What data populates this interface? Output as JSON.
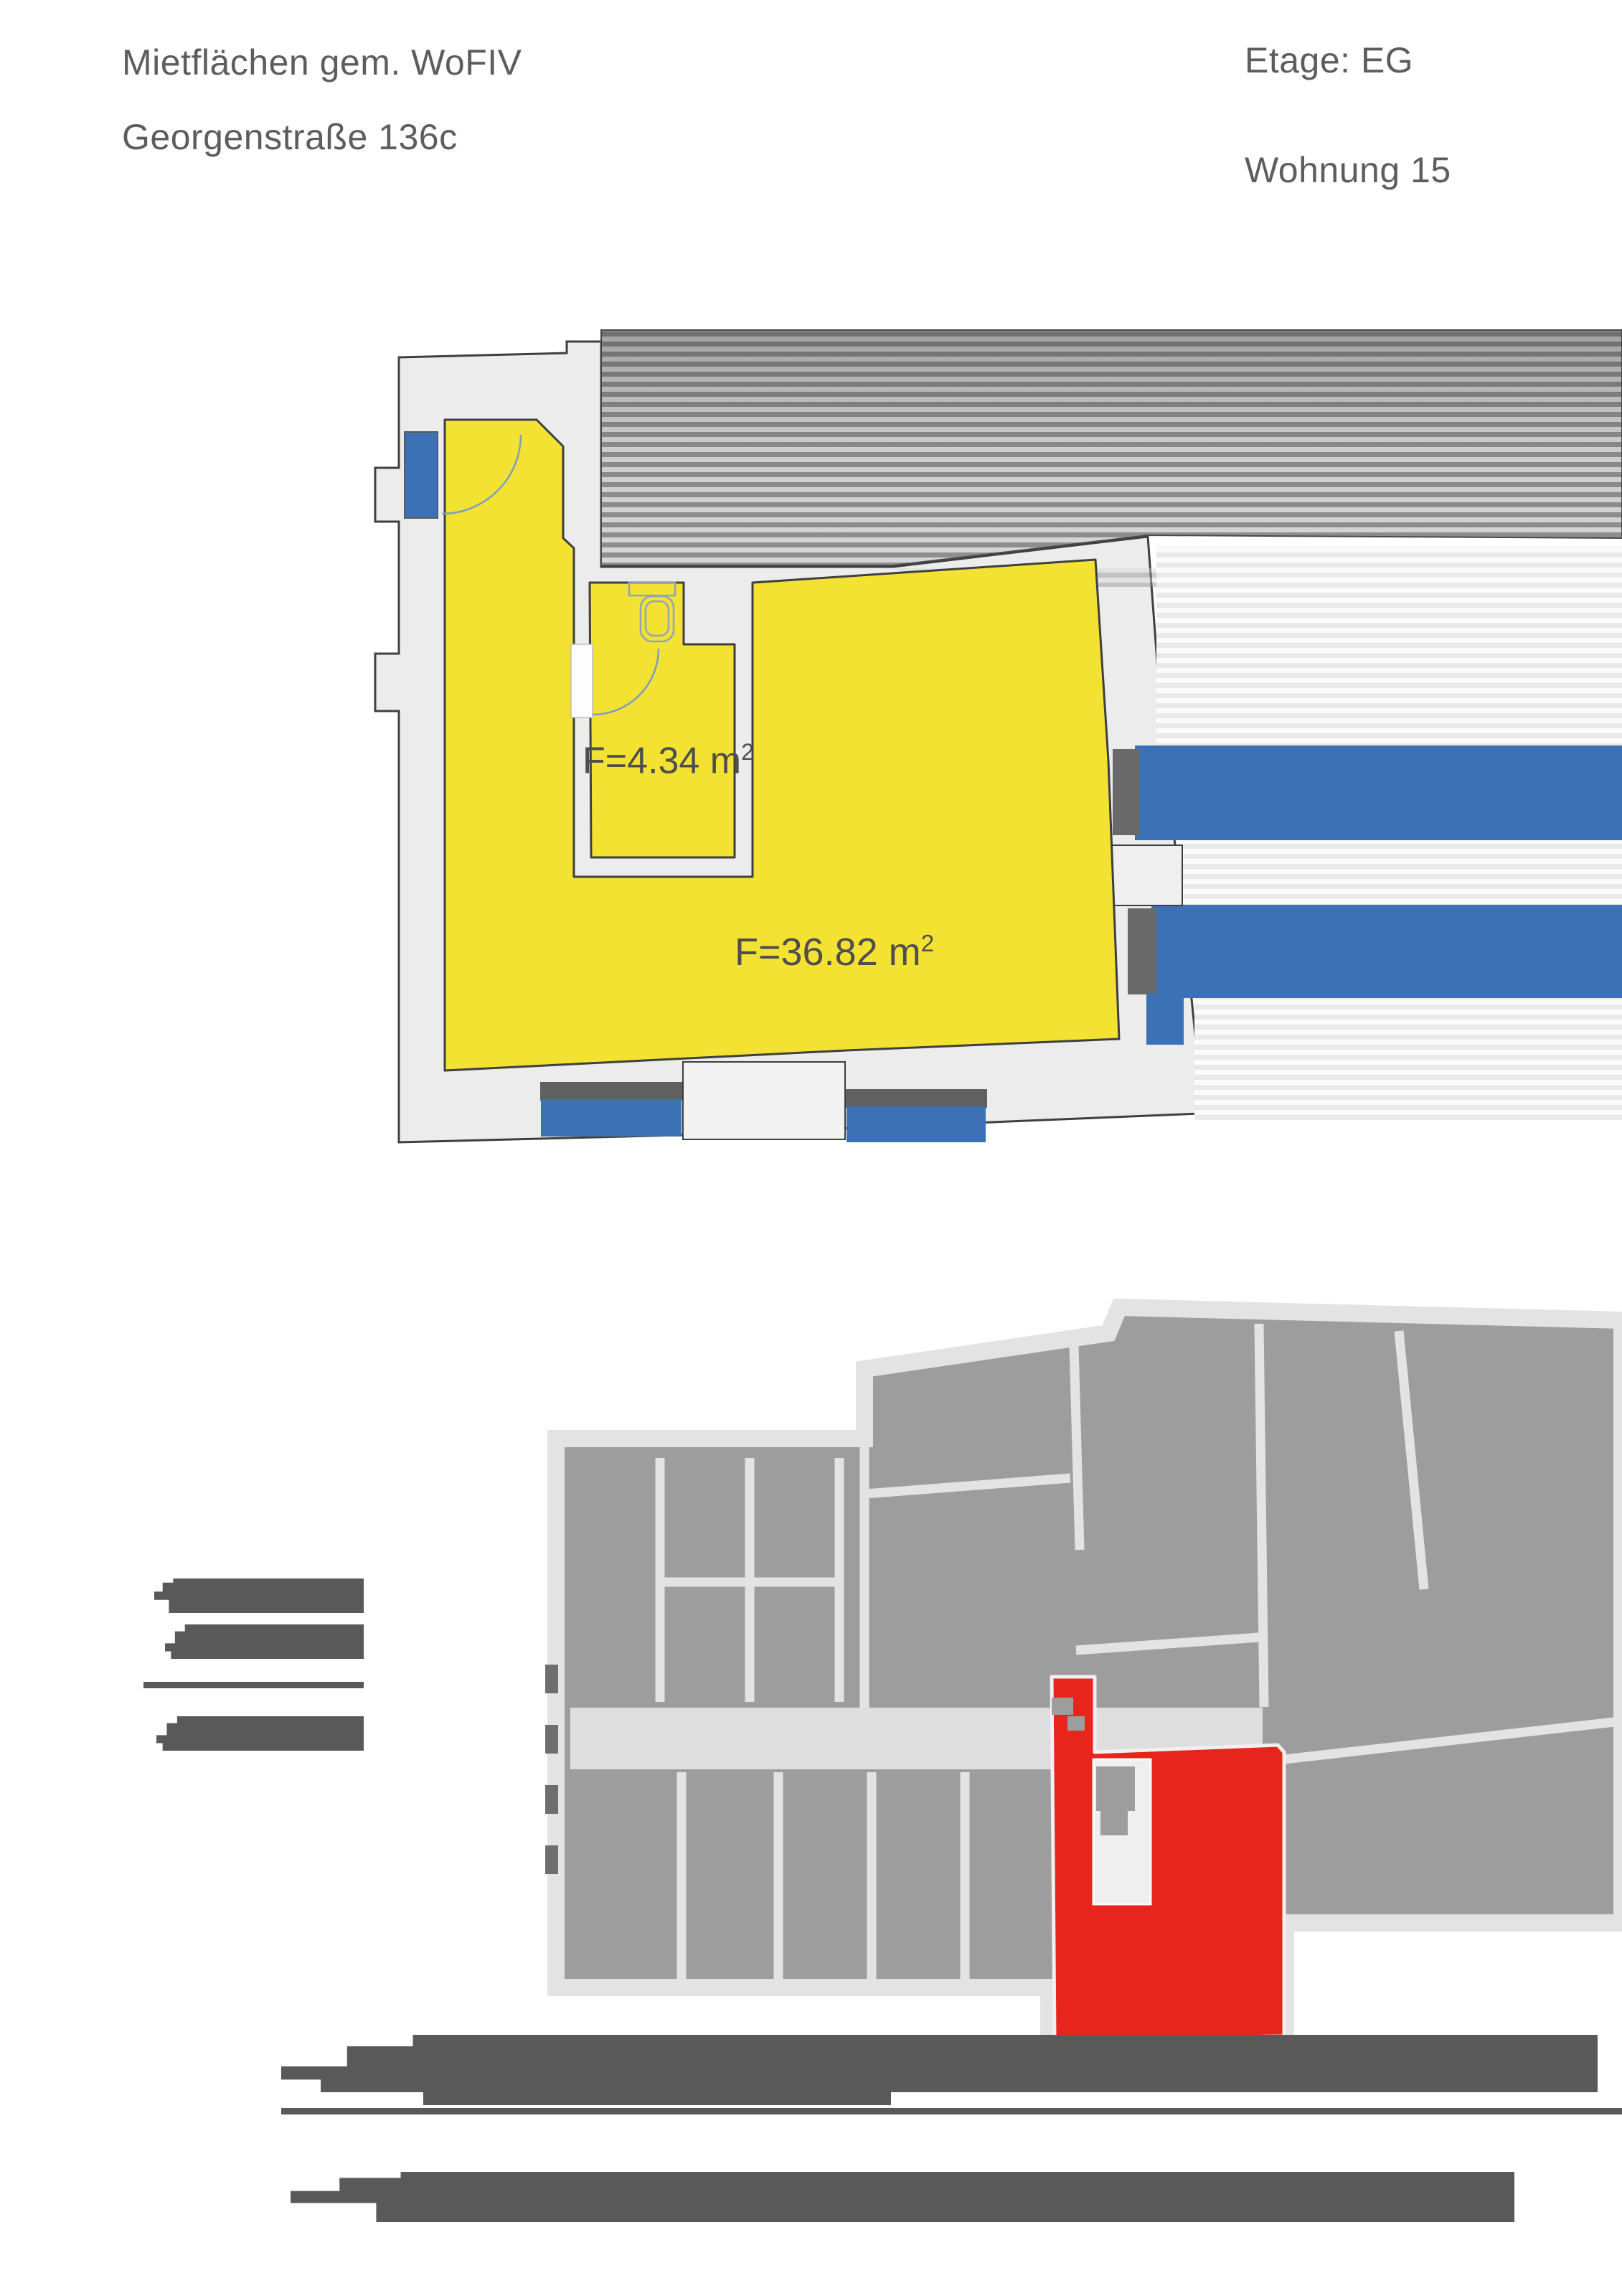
{
  "header": {
    "title_line1": "Mietflächen gem. WoFIV",
    "title_line2": "Georgenstraße 136c",
    "floor_label": "Etage: EG",
    "unit_label": "Wohnung 15"
  },
  "plan": {
    "rooms": [
      {
        "id": "bathroom",
        "area_text": "F=4.34 m",
        "area_sup": "2"
      },
      {
        "id": "main-room",
        "area_text": "F=36.82 m",
        "area_sup": "2"
      }
    ],
    "colors": {
      "rented_area_yellow": "#f4e233",
      "window_blue": "#3c72b5",
      "wall_fill": "#ececec",
      "wall_outline": "#3f3f3f",
      "hatch_dark": "#8e8e8e",
      "hatch_light": "#d6d6d6"
    }
  },
  "overview": {
    "colors": {
      "building_gray": "#9d9d9d",
      "wall_light": "#e3e3e3",
      "unit_highlight_red": "#e8251c"
    }
  },
  "redactions": {
    "color": "#595959"
  }
}
